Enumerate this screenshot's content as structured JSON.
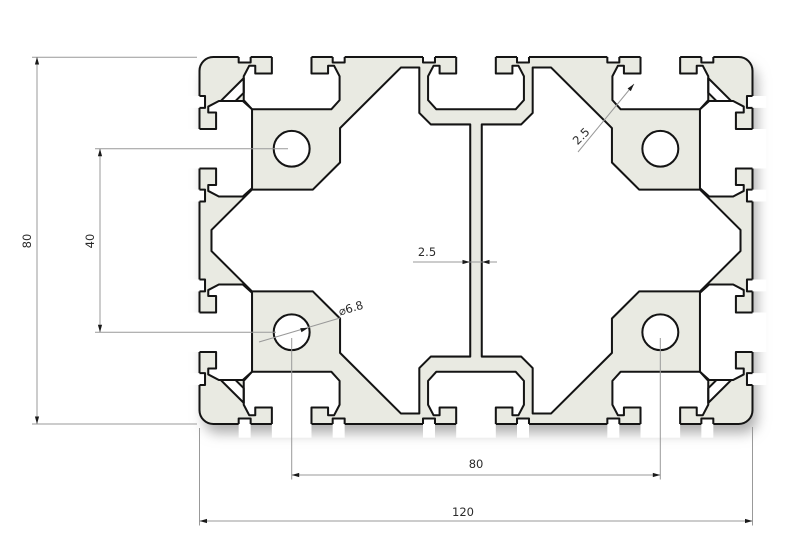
{
  "drawing": {
    "type": "technical-cross-section",
    "subject": "aluminum-extrusion-profile",
    "background": "#ffffff",
    "profile": {
      "width_mm": 120,
      "height_mm": 80,
      "module_mm": 40,
      "web_thickness_mm": 2.5,
      "wall_thickness_mm": 2.5,
      "hole_diameter_mm": 6.8,
      "corner_radius_mm": 3,
      "fill_color": "#e9eae2",
      "outline_color": "#141414"
    },
    "dimensions": {
      "overall_height": {
        "label": "80"
      },
      "hole_spacing_vertical": {
        "label": "40"
      },
      "hole_spacing_horizontal": {
        "label": "80"
      },
      "overall_width": {
        "label": "120"
      },
      "center_web_thickness": {
        "label": "2.5"
      },
      "wall_thickness": {
        "label": "2.5"
      },
      "hole_diameter": {
        "label": "⌀6.8"
      }
    },
    "style": {
      "dimension_line_color": "#999999",
      "arrow_color": "#1a1a1a",
      "text_color": "#2b2b2b"
    }
  }
}
